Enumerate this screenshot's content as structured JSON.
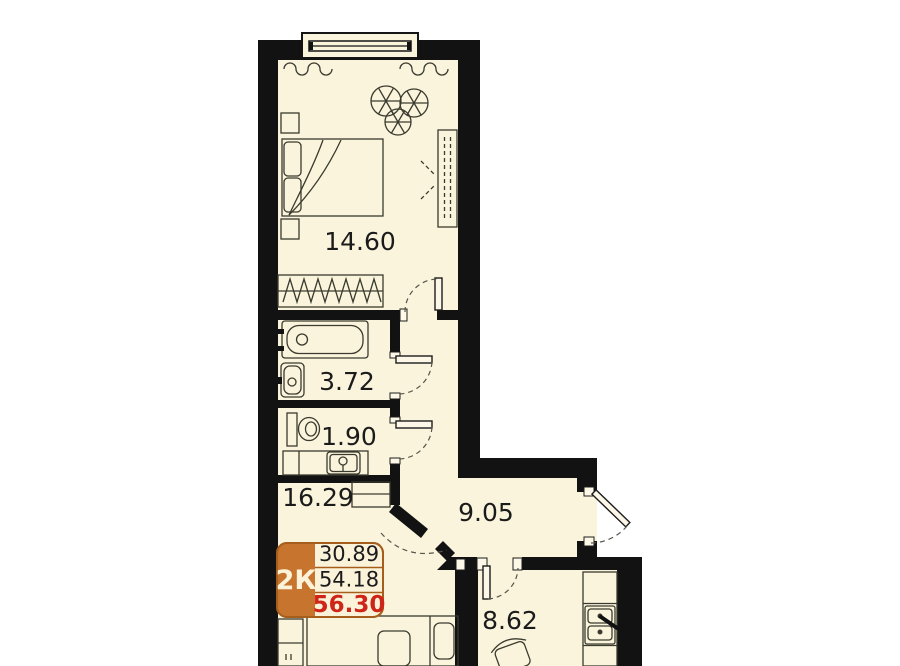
{
  "plan": {
    "unit_badge": {
      "type_label": "2К",
      "rows": [
        {
          "value": "30.89",
          "highlighted": false
        },
        {
          "value": "54.18",
          "highlighted": false
        },
        {
          "value": "56.30",
          "highlighted": true
        }
      ]
    },
    "rooms": [
      {
        "name": "bedroom",
        "area": "14.60"
      },
      {
        "name": "bathroom",
        "area": "3.72"
      },
      {
        "name": "wc",
        "area": "1.90"
      },
      {
        "name": "living-room",
        "area": "16.29"
      },
      {
        "name": "hallway",
        "area": "9.05"
      },
      {
        "name": "kitchen",
        "area": "8.62"
      }
    ],
    "icons": [
      "window",
      "curtains-icon",
      "plant-icon",
      "double-bed-icon",
      "nightstand-icon",
      "sliding-wardrobe-icon",
      "hanger-wardrobe-icon",
      "bathtub-icon",
      "washbasin-icon",
      "toilet-icon",
      "counter-sink-icon",
      "shelf-icon",
      "closet-icon",
      "sofa-bed-icon",
      "kitchen-counter-icon",
      "kitchen-sink-icon",
      "chair-icon",
      "door-leaf",
      "door-swing-arc",
      "entrance-door"
    ]
  },
  "colors": {
    "background": "#ffffff",
    "floor": "#faf4dc",
    "wall": "#121212",
    "line": "#3a3a2e",
    "badge-orange": "#c7752e",
    "badge-border": "#a55e1c",
    "badge-text": "#fdf3d8",
    "accent-red": "#cf2418",
    "label": "#1b1b1b"
  }
}
